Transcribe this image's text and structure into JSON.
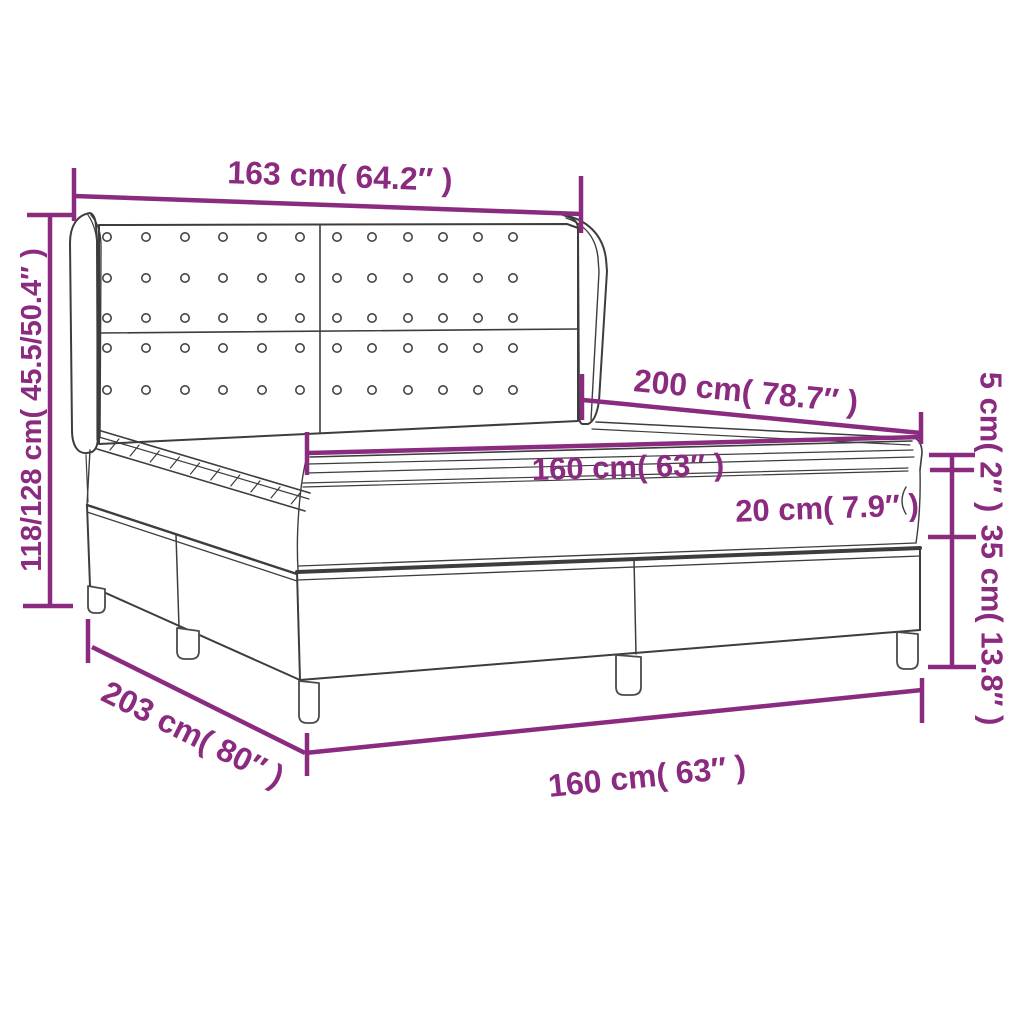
{
  "diagram": {
    "type": "product-dimension-diagram",
    "subject": "box spring bed with tufted wingback headboard",
    "background_color": "#ffffff",
    "accent_color": "#8B2B80",
    "line_color": "#3d3d3d",
    "dimensions": {
      "headboard_width": "163 cm( 64.2″ )",
      "headboard_height": "118/128 cm( 45.5/50.4″ )",
      "bed_depth": "200 cm( 78.7″ )",
      "mattress_width": "160 cm( 63″ )",
      "topper_height": "5 cm( 2″ )",
      "mattress_height": "20 cm( 7.9″ )",
      "base_height": "35 cm( 13.8″ )",
      "bed_length": "203 cm( 80″ )",
      "base_width": "160 cm( 63″ )"
    }
  }
}
